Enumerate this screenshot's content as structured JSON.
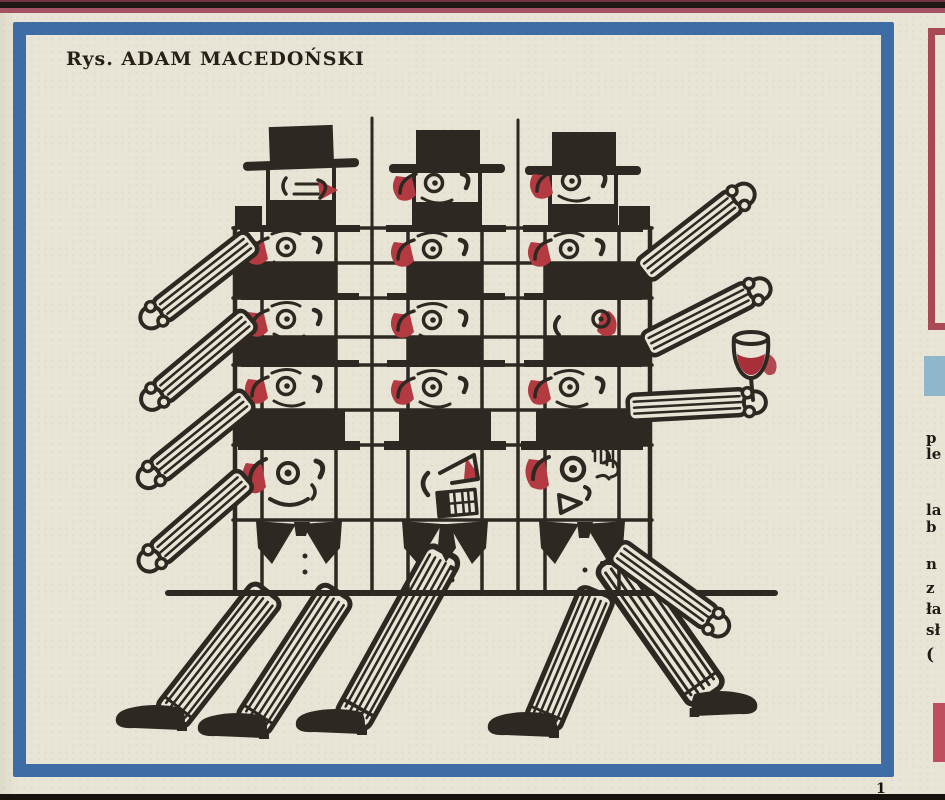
{
  "page": {
    "caption": "Rys. ADAM MACEDOŃSKI"
  },
  "right_column": {
    "fragments": [
      "p",
      "le",
      "la",
      "b",
      "n",
      "z",
      "ła",
      "sł",
      "("
    ]
  },
  "footer": {
    "mark": "1"
  },
  "colors": {
    "paper": "#e8e5d6",
    "ink": "#2d2822",
    "accent_red": "#b23a40",
    "wine_red": "#a82e38",
    "frame_blue": "#3e6da6",
    "panel_light_blue": "#8fb6cb",
    "box_border_red": "#a84a55",
    "box_fill_red": "#bf4f60",
    "top_bar_maroon": "#a25263"
  }
}
